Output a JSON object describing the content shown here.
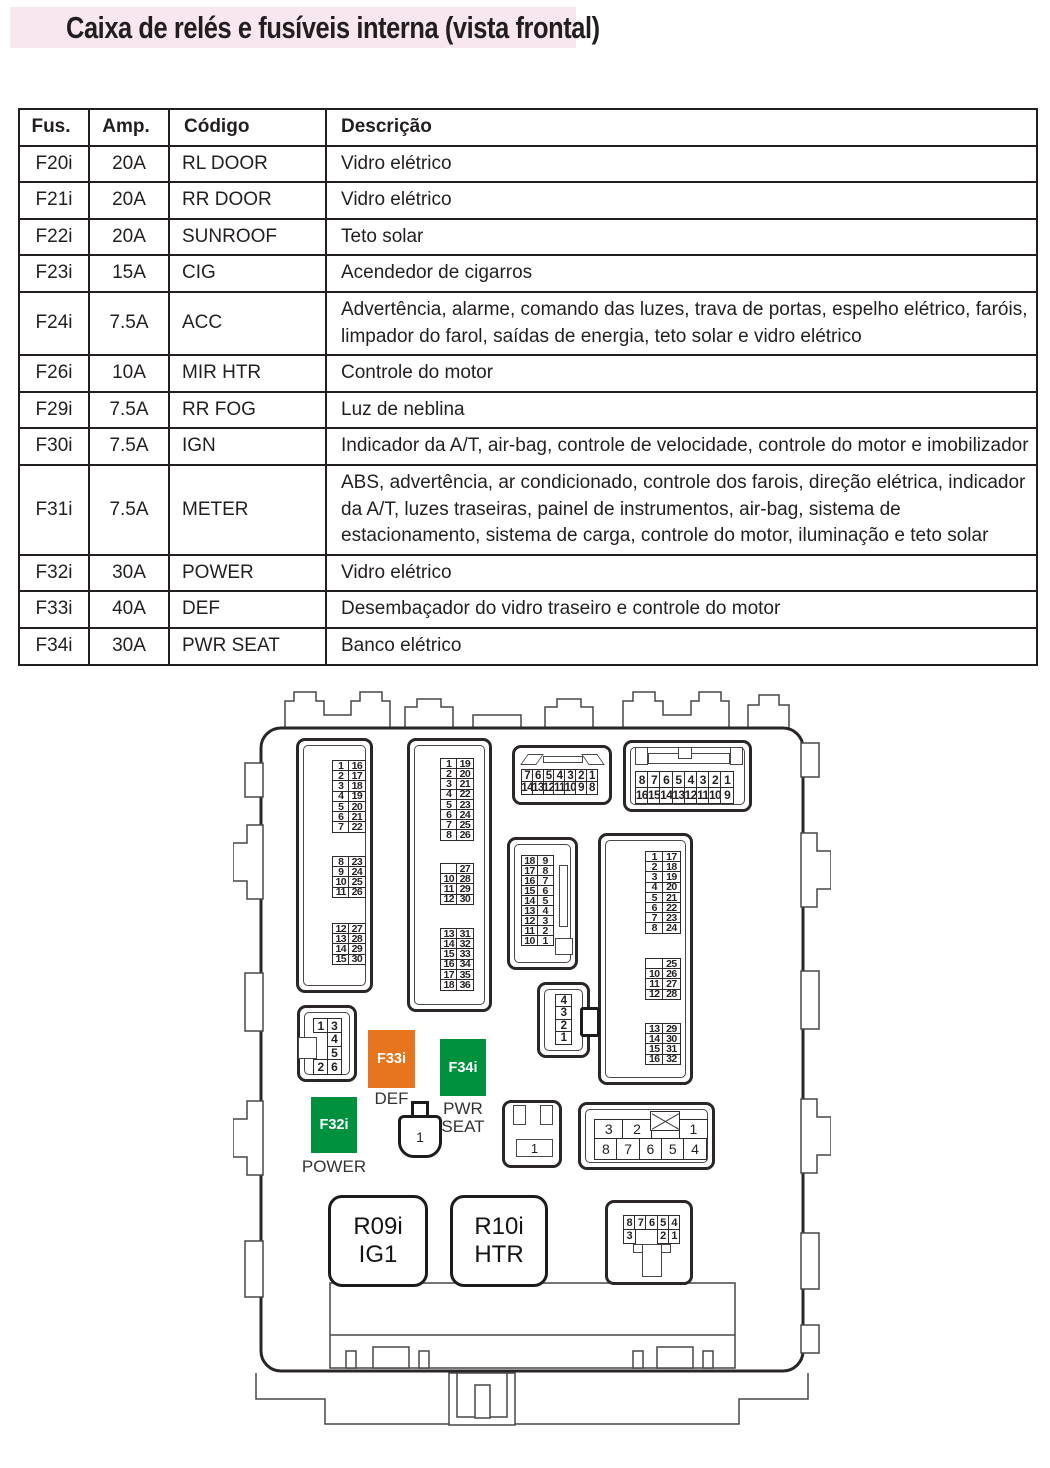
{
  "title": "Caixa de relés e fusíveis interna (vista frontal)",
  "table": {
    "headers": [
      "Fus.",
      "Amp.",
      "Código",
      "Descrição"
    ],
    "rows": [
      [
        "F20i",
        "20A",
        "RL DOOR",
        "Vidro elétrico"
      ],
      [
        "F21i",
        "20A",
        "RR DOOR",
        "Vidro elétrico"
      ],
      [
        "F22i",
        "20A",
        "SUNROOF",
        "Teto solar"
      ],
      [
        "F23i",
        "15A",
        "CIG",
        "Acendedor de cigarros"
      ],
      [
        "F24i",
        "7.5A",
        "ACC",
        "Advertência, alarme, comando das luzes, trava de portas, espelho elétrico, faróis, limpador do farol, saídas de energia,  teto solar e vidro elétrico"
      ],
      [
        "F26i",
        "10A",
        "MIR HTR",
        "Controle do motor"
      ],
      [
        "F29i",
        "7.5A",
        "RR FOG",
        "Luz de neblina"
      ],
      [
        "F30i",
        "7.5A",
        "IGN",
        "Indicador da A/T, air-bag, controle de velocidade, controle do motor e imobilizador"
      ],
      [
        "F31i",
        "7.5A",
        "METER",
        "ABS, advertência, ar condicionado, controle dos farois, direção elétrica, indicador da A/T, luzes traseiras, painel de instrumentos, air-bag, sistema de estacionamento, sistema de carga, controle do motor, iluminação e teto solar"
      ],
      [
        "F32i",
        "30A",
        "POWER",
        "Vidro elétrico"
      ],
      [
        "F33i",
        "40A",
        "DEF",
        "Desembaçador do vidro traseiro e controle do motor"
      ],
      [
        "F34i",
        "30A",
        "PWR SEAT",
        "Banco elétrico"
      ]
    ]
  },
  "diagram": {
    "connector_pins": {
      "a1": [
        [
          "1",
          "16"
        ],
        [
          "2",
          "17"
        ],
        [
          "3",
          "18"
        ],
        [
          "4",
          "19"
        ],
        [
          "5",
          "20"
        ],
        [
          "6",
          "21"
        ],
        [
          "7",
          "22"
        ]
      ],
      "a2": [
        [
          "8",
          "23"
        ],
        [
          "9",
          "24"
        ],
        [
          "10",
          "25"
        ],
        [
          "11",
          "26"
        ]
      ],
      "a3": [
        [
          "12",
          "27"
        ],
        [
          "13",
          "28"
        ],
        [
          "14",
          "29"
        ],
        [
          "15",
          "30"
        ]
      ],
      "b1": [
        [
          "1",
          "19"
        ],
        [
          "2",
          "20"
        ],
        [
          "3",
          "21"
        ],
        [
          "4",
          "22"
        ],
        [
          "5",
          "23"
        ],
        [
          "6",
          "24"
        ],
        [
          "7",
          "25"
        ],
        [
          "8",
          "26"
        ]
      ],
      "b2": [
        [
          "",
          "27"
        ],
        [
          "10",
          "28"
        ],
        [
          "11",
          "29"
        ],
        [
          "12",
          "30"
        ]
      ],
      "b3": [
        [
          "13",
          "31"
        ],
        [
          "14",
          "32"
        ],
        [
          "15",
          "33"
        ],
        [
          "16",
          "34"
        ],
        [
          "17",
          "35"
        ],
        [
          "18",
          "36"
        ]
      ],
      "c": [
        [
          "7",
          "6",
          "5",
          "4",
          "3",
          "2",
          "1"
        ],
        [
          "14",
          "13",
          "12",
          "11",
          "10",
          "9",
          "8"
        ]
      ],
      "d": [
        [
          "8",
          "7",
          "6",
          "5",
          "4",
          "3",
          "2",
          "1"
        ],
        [
          "16",
          "15",
          "14",
          "13",
          "12",
          "11",
          "10",
          "9"
        ]
      ],
      "e": [
        [
          "18",
          "9"
        ],
        [
          "17",
          "8"
        ],
        [
          "16",
          "7"
        ],
        [
          "15",
          "6"
        ],
        [
          "14",
          "5"
        ],
        [
          "13",
          "4"
        ],
        [
          "12",
          "3"
        ],
        [
          "11",
          "2"
        ],
        [
          "10",
          "1"
        ]
      ],
      "f1": [
        [
          "1",
          "17"
        ],
        [
          "2",
          "18"
        ],
        [
          "3",
          "19"
        ],
        [
          "4",
          "20"
        ],
        [
          "5",
          "21"
        ],
        [
          "6",
          "22"
        ],
        [
          "7",
          "23"
        ],
        [
          "8",
          "24"
        ]
      ],
      "f2": [
        [
          "",
          "25"
        ],
        [
          "10",
          "26"
        ],
        [
          "11",
          "27"
        ],
        [
          "12",
          "28"
        ]
      ],
      "f3": [
        [
          "13",
          "29"
        ],
        [
          "14",
          "30"
        ],
        [
          "15",
          "31"
        ],
        [
          "16",
          "32"
        ]
      ],
      "g": [
        [
          "1",
          "3"
        ],
        [
          null,
          "4"
        ],
        [
          null,
          "5"
        ],
        [
          "2",
          "6"
        ]
      ],
      "quad": [
        [
          "4"
        ],
        [
          "3"
        ],
        [
          "2"
        ],
        [
          "1"
        ]
      ],
      "h": [
        [
          "3",
          "2",
          "X",
          "1"
        ],
        [
          "8",
          "7",
          "6",
          "5",
          "4"
        ]
      ],
      "i": [
        [
          "8",
          "7",
          "6",
          "5",
          "4"
        ],
        [
          "3",
          null,
          null,
          "2",
          "1"
        ]
      ]
    },
    "plug_labels": {
      "round_plug": "1",
      "box_plug": "1"
    },
    "fuses": [
      {
        "id": "F33i",
        "label": "DEF",
        "color": "#E6751D"
      },
      {
        "id": "F34i",
        "label": "PWR SEAT",
        "color": "#00913F"
      },
      {
        "id": "F32i",
        "label": "POWER",
        "color": "#00913F"
      }
    ],
    "relays": [
      {
        "name": "R09i",
        "code": "IG1"
      },
      {
        "name": "R10i",
        "code": "HTR"
      }
    ]
  }
}
